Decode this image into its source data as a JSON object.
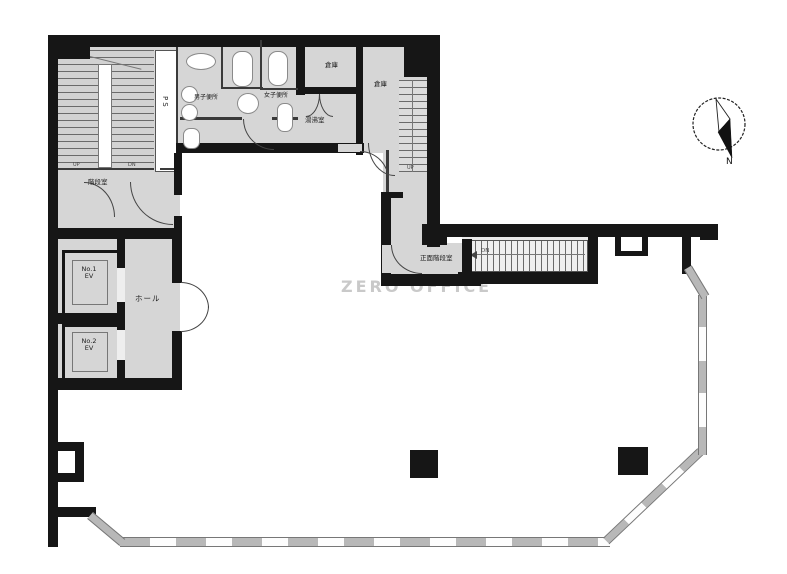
{
  "watermark": "ZERO OFFICE",
  "compass": {
    "north_label": "N"
  },
  "colors": {
    "wall": "#161616",
    "service_floor": "#d6d6d6",
    "window_wall": "#b8b8b8",
    "watermark": "#c9c9c9"
  },
  "rooms": {
    "mens_toilet": {
      "label": "男子便所"
    },
    "womens_toilet": {
      "label": "女子便所"
    },
    "storage_1": {
      "label": "倉庫"
    },
    "storage_2": {
      "label": "倉庫"
    },
    "kitchenette": {
      "label": "湯沸室"
    },
    "pipe_shaft": {
      "label": "PS"
    },
    "stairwell": {
      "label": "階段室"
    },
    "front_stairwell": {
      "label": "正面階段室"
    },
    "hall": {
      "label": "ホール"
    },
    "elevator_1": {
      "line1": "No.1",
      "line2": "EV"
    },
    "elevator_2": {
      "line1": "No.2",
      "line2": "EV"
    }
  },
  "stairs": {
    "main_up": "UP",
    "main_dn": "DN",
    "inner_up": "UP",
    "outer_dn": "DN"
  }
}
